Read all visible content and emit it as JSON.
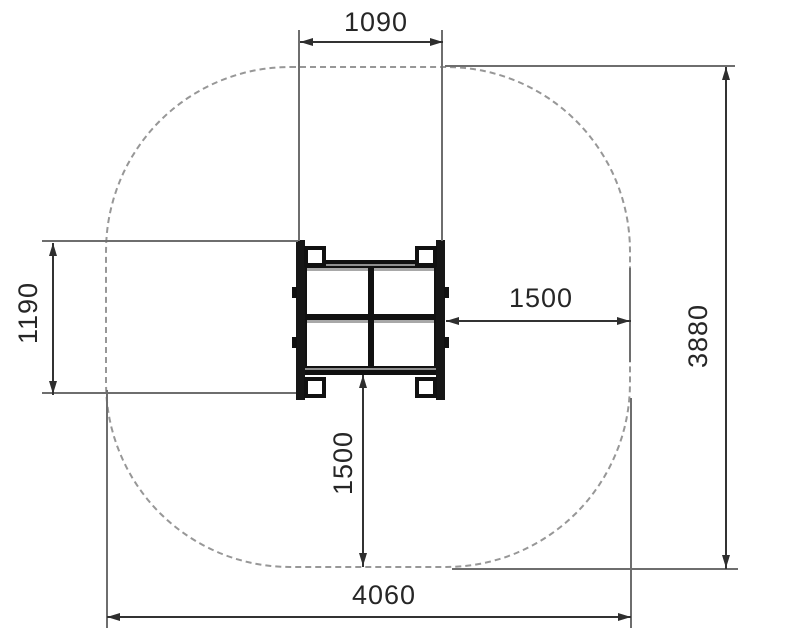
{
  "diagram": {
    "dims": {
      "width_top": "1090",
      "height_left": "1190",
      "clearance_right": "1500",
      "clearance_bottom": "1500",
      "total_height": "3880",
      "total_width": "4060"
    },
    "colors": {
      "background": "#ffffff",
      "equipment": "#161616",
      "dimension_line": "#333333",
      "extension_line": "#6e6e6e",
      "zone_dash": "#979797",
      "text": "#262626"
    }
  }
}
